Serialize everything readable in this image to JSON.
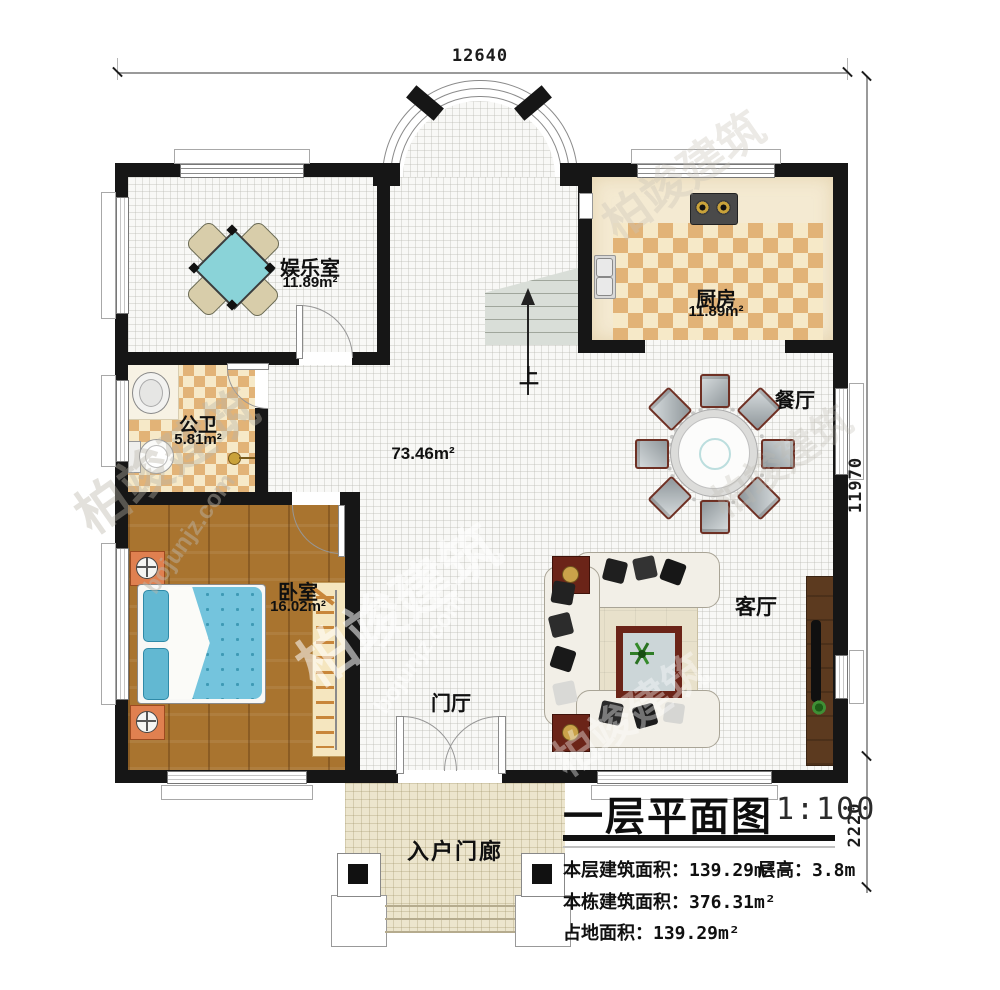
{
  "meta": {
    "plan_title": "一层平面图",
    "scale": "1:100"
  },
  "dimensions": {
    "top_width": "12640",
    "right_height": "11970",
    "porch_depth": "2220"
  },
  "rooms": [
    {
      "name": "娱乐室",
      "area": "11.89m²"
    },
    {
      "name": "厨房",
      "area": "11.89m²"
    },
    {
      "name": "公卫",
      "area": "5.81m²"
    },
    {
      "name": "卧室",
      "area": "16.02m²"
    },
    {
      "name": "餐厅"
    },
    {
      "name": "客厅"
    },
    {
      "name": "门厅"
    },
    {
      "name": "入户门廊"
    }
  ],
  "hall": {
    "area": "73.46m²"
  },
  "stairs": {
    "direction_label": "上"
  },
  "title_block": {
    "title": "一层平面图",
    "scale": "1:100",
    "stats": [
      {
        "label": "本层建筑面积：",
        "value": "139.29m²"
      },
      {
        "label": "本栋建筑面积：",
        "value": "376.31m²"
      },
      {
        "label": "占地面积：",
        "value": "139.29m²"
      }
    ],
    "floor_height": {
      "label": "层高：",
      "value": "3.8m"
    }
  },
  "watermark": {
    "brand": "柏竣建筑",
    "site": "bojunjz.com"
  },
  "colors": {
    "wall": "#161616",
    "checker_dark": "#e2b377",
    "checker_light": "#f6e9c8",
    "wood_floor": "#a9742f",
    "bed_blue": "#74c4dd",
    "game_table_teal": "#8ad3d8",
    "sofa_cream": "#f2efe7",
    "tv_cabinet_brown": "#5c3a1f",
    "accent_red": "#6b2418"
  }
}
